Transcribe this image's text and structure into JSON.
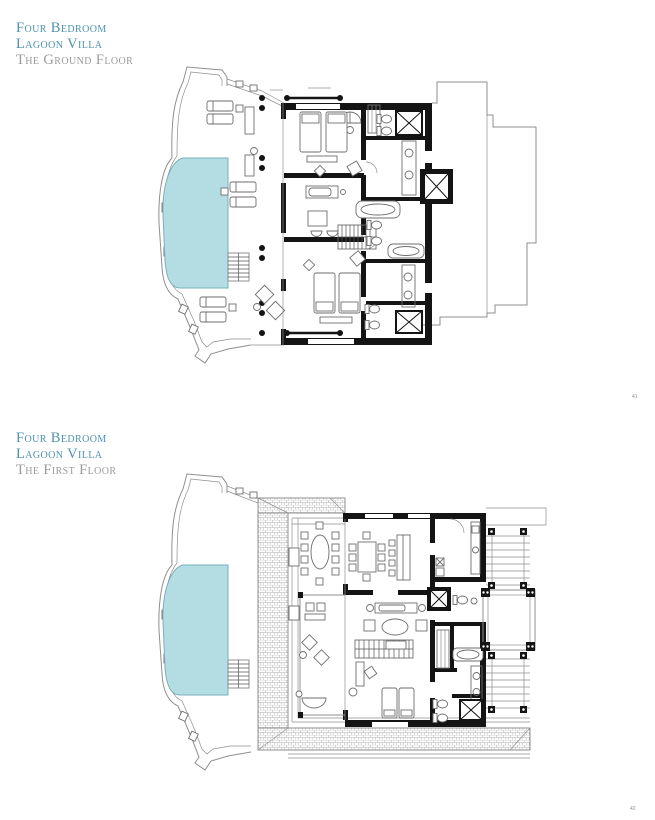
{
  "page": {
    "width": 655,
    "height": 820,
    "background": "#ffffff"
  },
  "colors": {
    "title-teal": "#4e93ad",
    "subtitle-gray": "#9b9b9b",
    "pool-fill": "#b3dde3",
    "pool-edge": "#7aafba",
    "wall-black": "#141414",
    "line-gray": "#8f8f8f",
    "furniture-gray": "#6e6e6e",
    "hatch-gray": "#b0b0b0"
  },
  "plans": [
    {
      "id": "ground-floor",
      "title_line1": "Four Bedroom",
      "title_line2": "Lagoon Villa",
      "subtitle": "The Ground Floor",
      "page_number": "41",
      "depicted_features": [
        "swimming-pool",
        "sun-deck",
        "terrace-colonnade",
        "guest-bedrooms",
        "bathrooms",
        "elevator",
        "interior-stairs",
        "entry-walkway"
      ]
    },
    {
      "id": "first-floor",
      "title_line1": "Four Bedroom",
      "title_line2": "Lagoon Villa",
      "subtitle": "The First Floor",
      "page_number": "42",
      "depicted_features": [
        "swimming-pool",
        "sun-deck",
        "roof-below",
        "outdoor-dining",
        "dining-room",
        "kitchen",
        "living-room",
        "bedrooms",
        "bathrooms",
        "elevator",
        "stairs",
        "timber-bridges",
        "water-platform"
      ]
    }
  ]
}
